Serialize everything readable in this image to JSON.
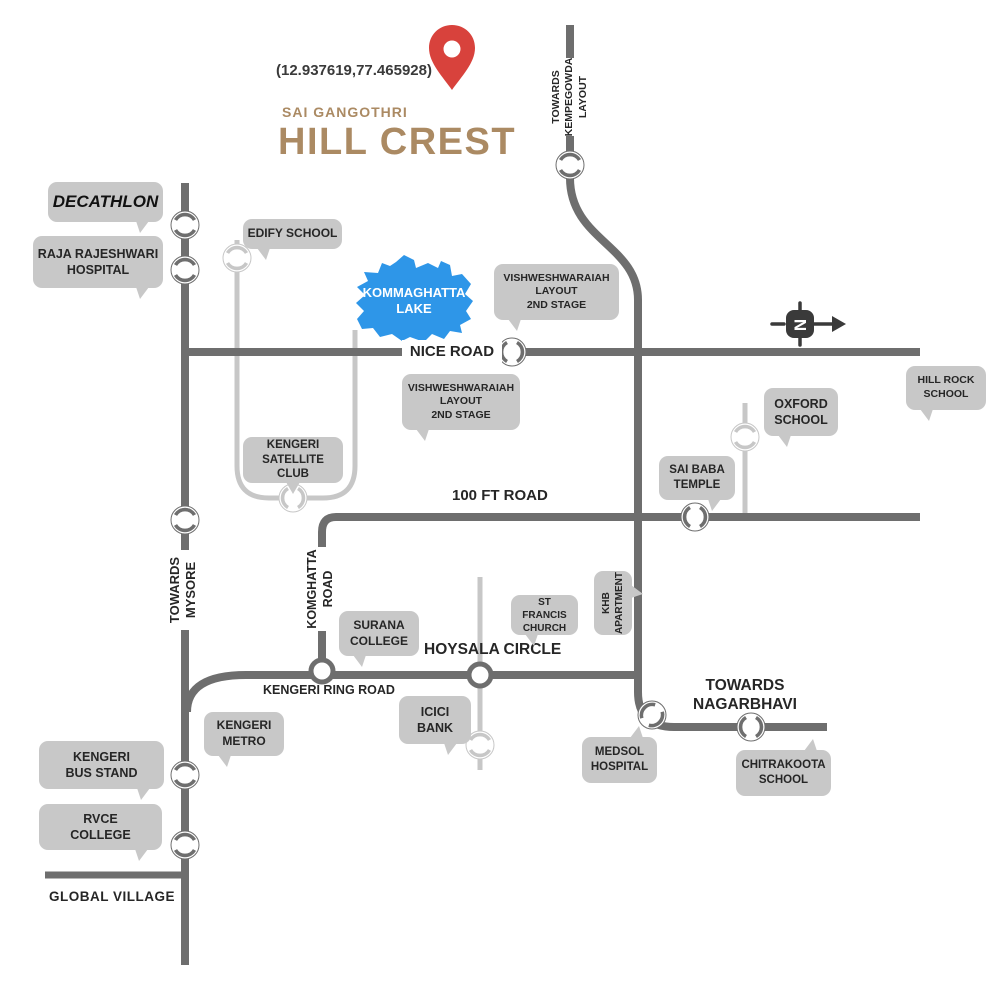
{
  "title": {
    "coordinates": "(12.937619,77.465928)",
    "brand": "SAI GANGOTHRI",
    "project": "HILL CREST"
  },
  "compass": {
    "letter": "N"
  },
  "colors": {
    "accent_tan": "#ab8a63",
    "pin_red": "#d8423c",
    "lake_blue": "#2e96e8",
    "road_dark": "#6e6e6e",
    "road_light": "#c7c7c7",
    "bubble_gray": "#c8c8c8"
  },
  "roads": {
    "nice": "NICE ROAD",
    "hundred_ft": "100 FT ROAD",
    "mysore": "TOWARDS\nMYSORE",
    "komghatta": "KOMGHATTA\nROAD",
    "kempegowda": "TOWARDS\nKEMPEGOWDA\nLAYOUT",
    "hoysala": "HOYSALA CIRCLE",
    "ring": "KENGERI RING ROAD",
    "nagarbhavi": "TOWARDS\nNAGARBHAVI",
    "global_village": "GLOBAL VILLAGE"
  },
  "landmarks": {
    "decathlon": "DECATHLON",
    "raja_rajeshwari_hospital": "RAJA RAJESHWARI\nHOSPITAL",
    "edify_school": "EDIFY SCHOOL",
    "kommaghatta_lake": "KOMMAGHATTA\nLAKE",
    "vishweshwaraiah_layout_1": "VISHWESHWARAIAH\nLAYOUT\n2ND STAGE",
    "vishweshwaraiah_layout_2": "VISHWESHWARAIAH\nLAYOUT\n2ND STAGE",
    "kengeri_satellite_club": "KENGERI\nSATELLITE CLUB",
    "oxford_school": "OXFORD\nSCHOOL",
    "hill_rock_school": "HILL ROCK\nSCHOOL",
    "sai_baba_temple": "SAI BABA\nTEMPLE",
    "surana_college": "SURANA\nCOLLEGE",
    "st_francis_church": "ST FRANCIS\nCHURCH",
    "khb_apartment": "KHB\nAPARTMENT",
    "icici_bank": "ICICI\nBANK",
    "kengeri_metro": "KENGERI\nMETRO",
    "kengeri_bus_stand": "KENGERI\nBUS STAND",
    "rvce_college": "RVCE\nCOLLEGE",
    "medsol_hospital": "MEDSOL\nHOSPITAL",
    "chitrakoota_school": "CHITRAKOOTA\nSCHOOL"
  }
}
